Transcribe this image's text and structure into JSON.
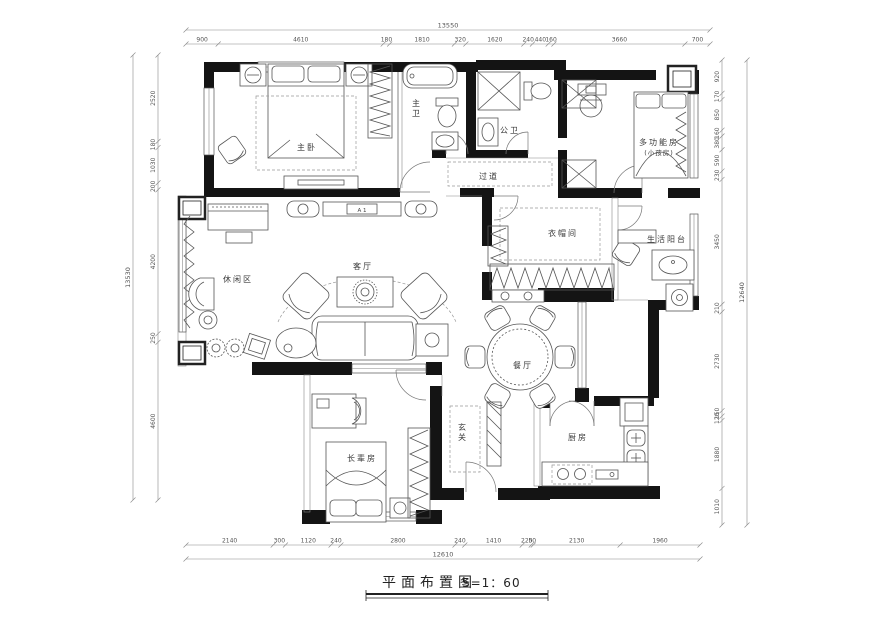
{
  "title": {
    "text": "平面布置图",
    "scale": "S=1：60"
  },
  "rooms": [
    {
      "id": "master-bedroom",
      "label": "主卧",
      "x": 307,
      "y": 150
    },
    {
      "id": "master-bath",
      "label": "主卫",
      "x": 417,
      "y": 106,
      "vertical": true
    },
    {
      "id": "public-bath",
      "label": "公卫",
      "x": 510,
      "y": 133
    },
    {
      "id": "corridor",
      "label": "过道",
      "x": 489,
      "y": 179
    },
    {
      "id": "multi-room",
      "label": "多功能房",
      "line2": "(小孩房)",
      "x": 659,
      "y": 145
    },
    {
      "id": "cloakroom",
      "label": "衣帽间",
      "x": 563,
      "y": 236
    },
    {
      "id": "living-balcony",
      "label": "生活阳台",
      "x": 667,
      "y": 242
    },
    {
      "id": "leisure-area",
      "label": "休闲区",
      "x": 238,
      "y": 282
    },
    {
      "id": "living-room",
      "label": "客厅",
      "x": 363,
      "y": 269
    },
    {
      "id": "dining-room",
      "label": "餐厅",
      "x": 523,
      "y": 368
    },
    {
      "id": "foyer",
      "label": "玄关",
      "x": 463,
      "y": 430,
      "vertical": true
    },
    {
      "id": "elder-room",
      "label": "长辈房",
      "x": 362,
      "y": 461
    },
    {
      "id": "kitchen",
      "label": "厨房",
      "x": 578,
      "y": 440
    }
  ],
  "annotations": [
    {
      "id": "tv-unit",
      "text": "A 1",
      "x": 362,
      "y": 212
    }
  ],
  "dimensions": {
    "top": {
      "total": "13550",
      "segments": [
        "900",
        "4610",
        "180",
        "1810",
        "320",
        "1620",
        "240",
        "440",
        "160",
        "3660",
        "700"
      ]
    },
    "left": {
      "total": "13530",
      "segments": [
        "2520",
        "180",
        "1030",
        "200",
        "4200",
        "250",
        "4600"
      ]
    },
    "right": {
      "total": "12640",
      "segments": [
        "920",
        "170",
        "850",
        "160",
        "380",
        "590",
        "230",
        "3450",
        "210",
        "2730",
        "150",
        "120",
        "1880",
        "1010"
      ]
    },
    "bottom": {
      "total": "12610",
      "segments": [
        "2140",
        "300",
        "1120",
        "240",
        "2800",
        "240",
        "1410",
        "220",
        "50",
        "2130",
        "1960"
      ]
    }
  }
}
